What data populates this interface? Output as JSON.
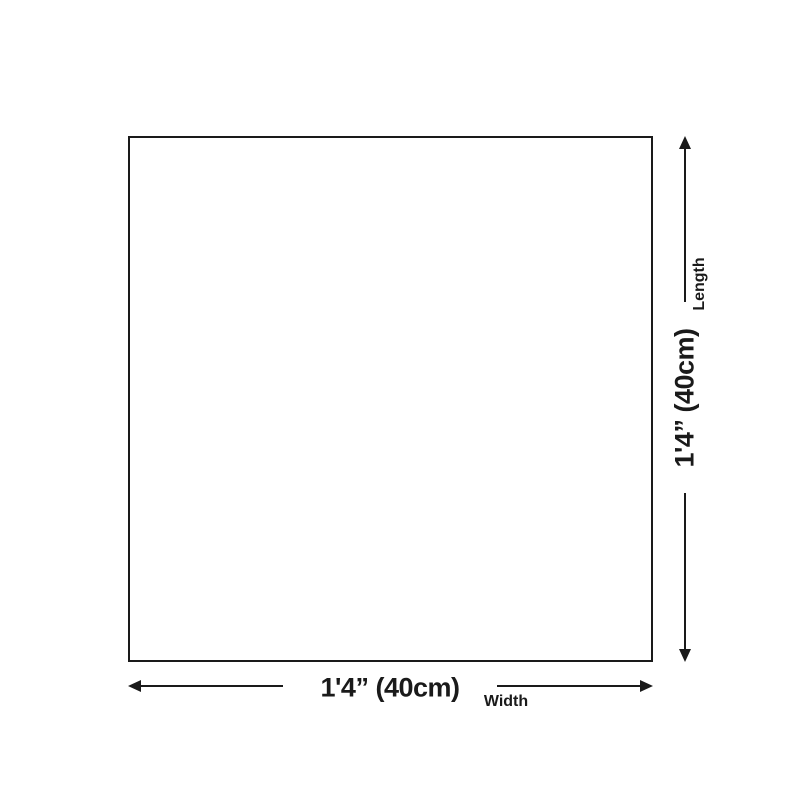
{
  "diagram": {
    "length": {
      "label": "Length",
      "value": "1'4” (40cm)"
    },
    "width": {
      "label": "Width",
      "value": "1'4” (40cm)"
    },
    "colors": {
      "ink": "#1a1a1a",
      "background": "#ffffff"
    }
  }
}
